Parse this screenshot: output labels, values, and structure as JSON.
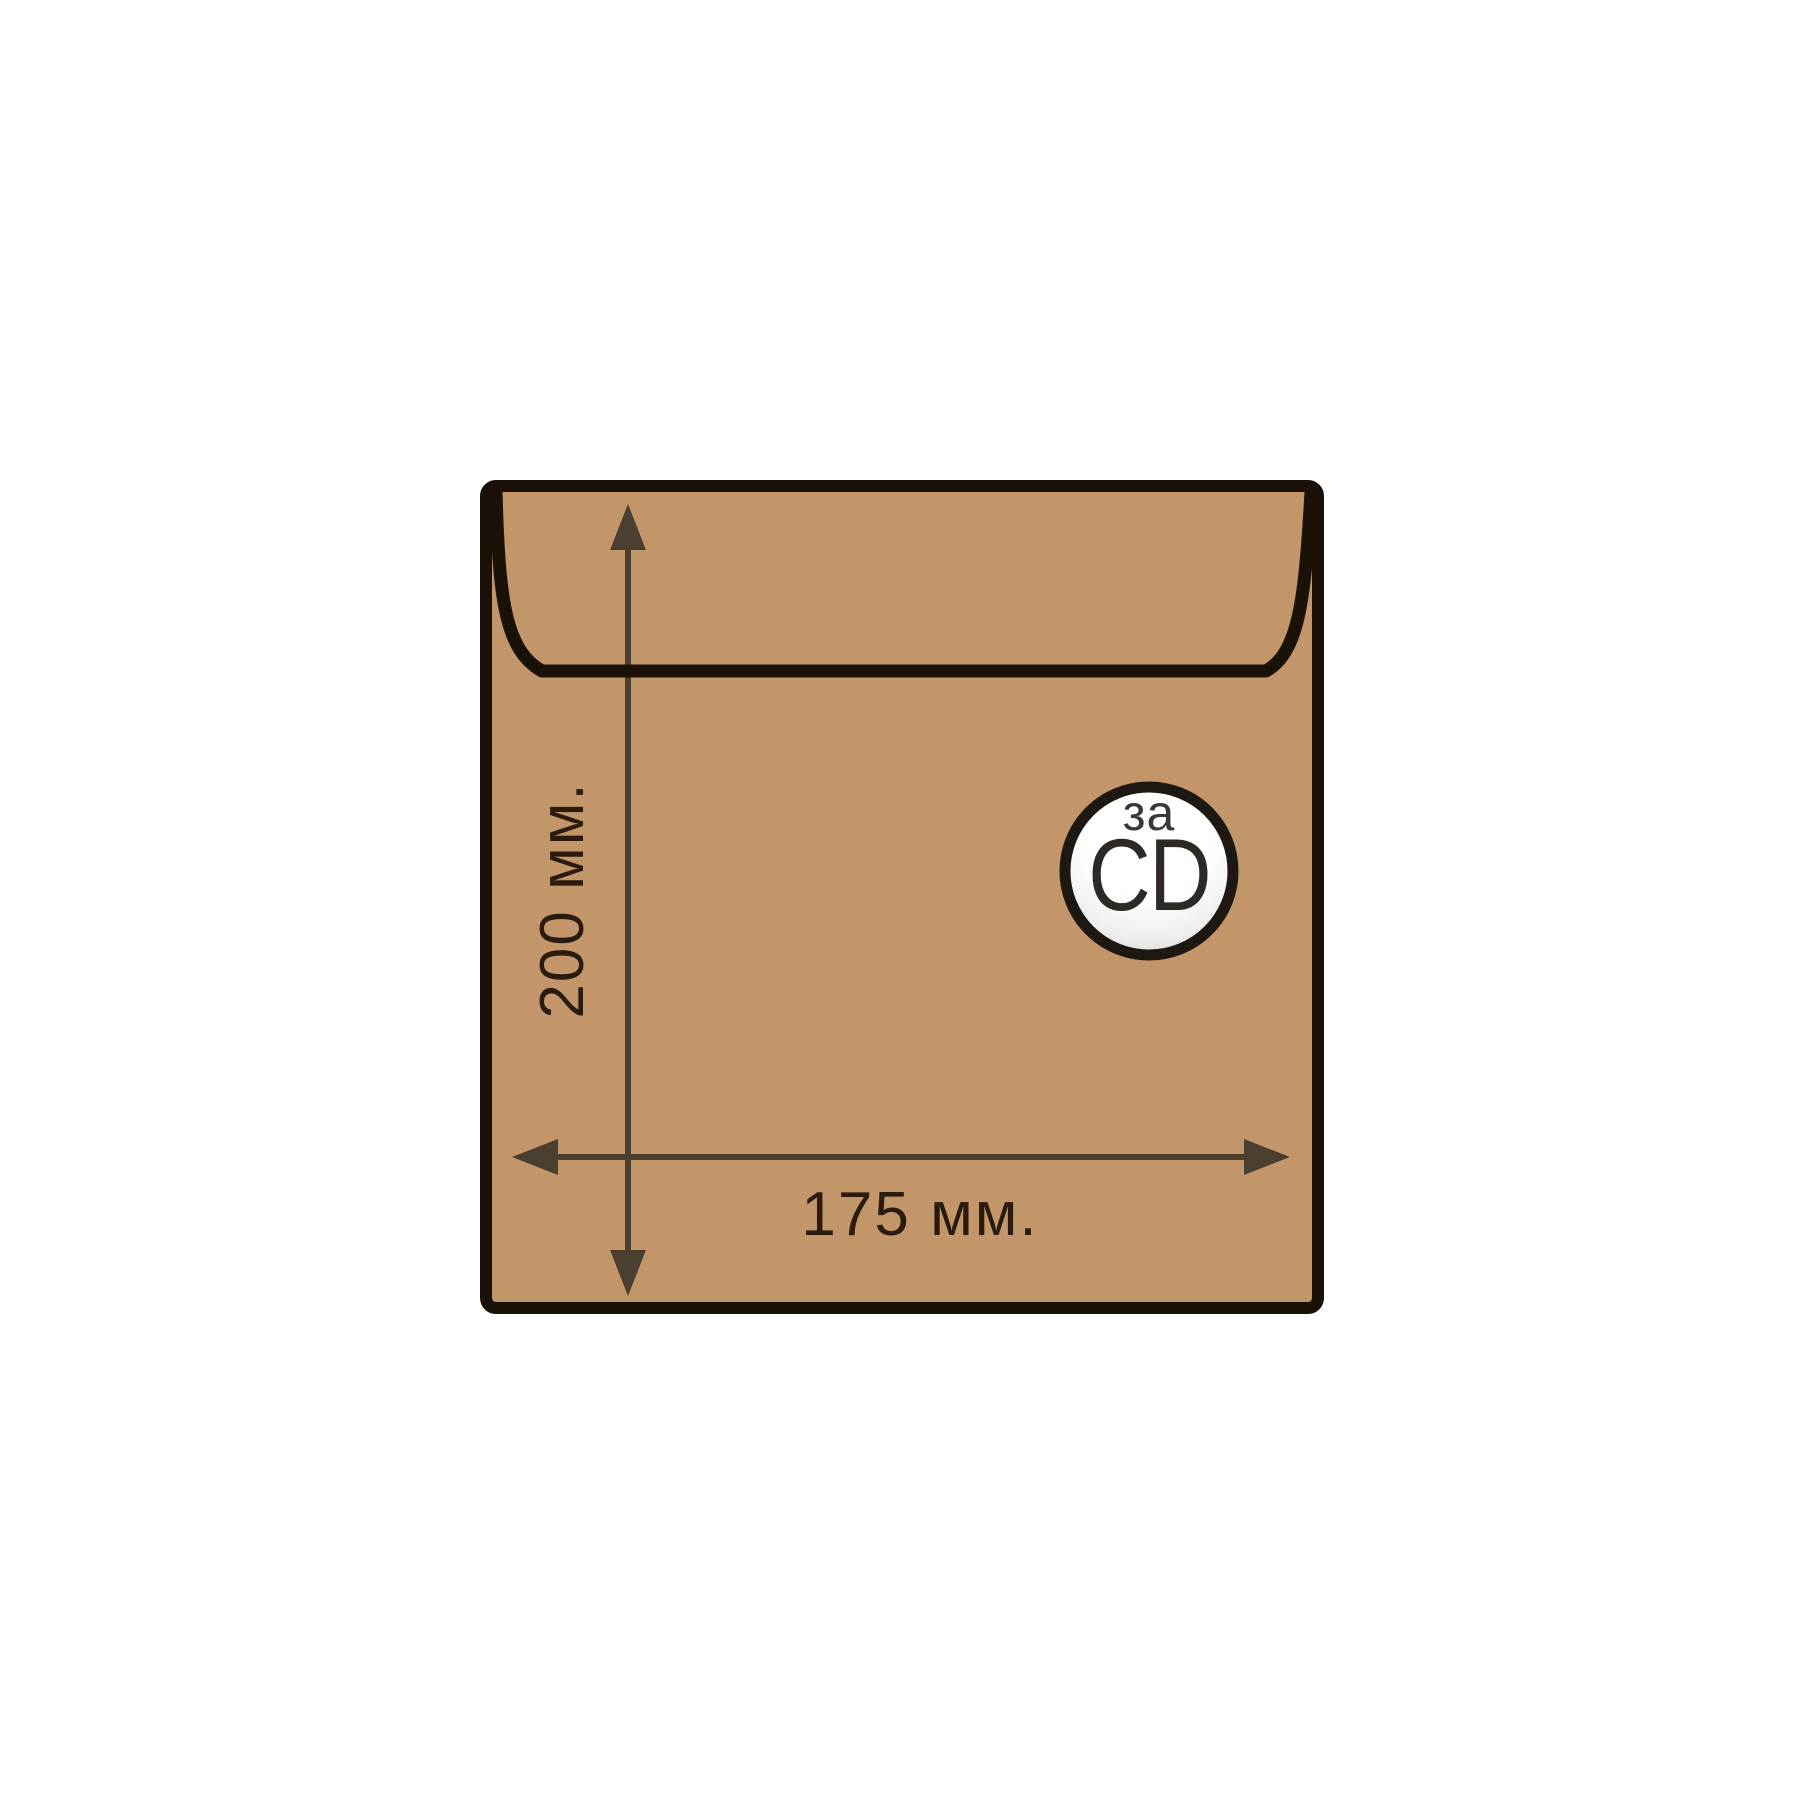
{
  "diagram": {
    "title": "envelope-size-diagram",
    "height_dimension": {
      "label": "200 мм."
    },
    "width_dimension": {
      "label": "175 мм."
    },
    "badge": {
      "top_text": "за",
      "main_text": "CD"
    },
    "colors": {
      "background": "#ffffff",
      "envelope_fill": "#c39669",
      "envelope_border": "#1a1208",
      "flap_line": "#1a1208",
      "arrow": "#4b3f31",
      "dimension_text": "#2a1b0e",
      "badge_ring": "#1e1813",
      "badge_text_top": "#3b3733",
      "badge_text_main": "#2d2a26",
      "badge_fill_light": "#ffffff",
      "badge_fill_mid": "#ededef",
      "badge_fill_dark": "#c3c3c9"
    }
  }
}
